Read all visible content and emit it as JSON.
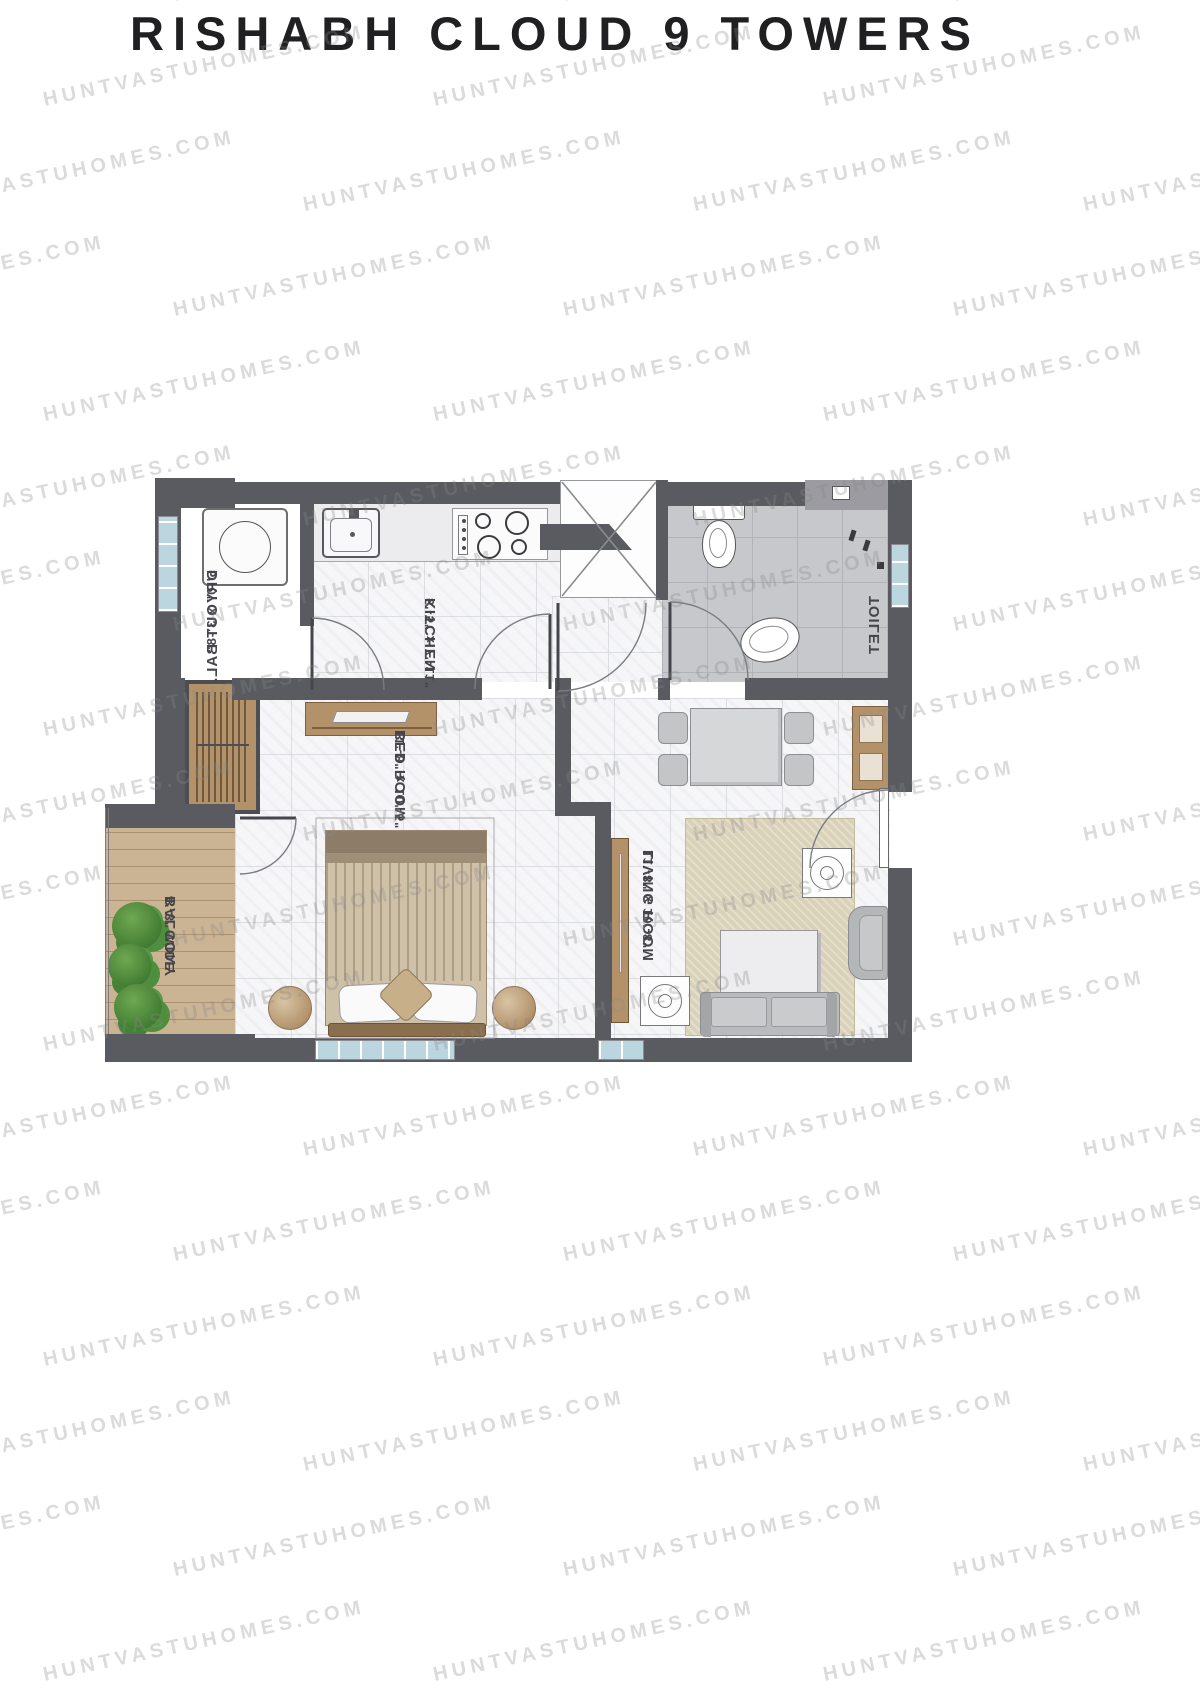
{
  "title": "RISHABH CLOUD 9 TOWERS",
  "watermark": {
    "text": "HUNTVASTUHOMES.COM"
  },
  "plan": {
    "rooms": {
      "dryout": {
        "name": "DRYOUT BAL.",
        "dims": "5'-0\" x 3'-8\""
      },
      "kitchen": {
        "name": "KITCHEN",
        "dims": "5'-5\" x 7'-11\""
      },
      "toilet": {
        "name": "TOILET",
        "dims": ""
      },
      "bedroom": {
        "name": "BED ROOM",
        "dims": "11'-8\" x 10'-5\""
      },
      "living": {
        "name": "LIVING ROOM",
        "dims": "11'-8\" x 10'-8\""
      },
      "balcony": {
        "name": "BALCONY",
        "dims": "4'-3\" WIDE"
      }
    },
    "fixtures": [
      "washbasin",
      "kitchen-sink",
      "gas-stove",
      "duct-shaft",
      "wc-toilet",
      "bathroom-basin",
      "wardrobe",
      "dresser",
      "double-bed",
      "pouf",
      "dining-table",
      "dining-chair",
      "sideboard",
      "rug",
      "coffee-table",
      "sofa",
      "armchair",
      "side-stool",
      "plant"
    ],
    "colors": {
      "wall": "#5a5b60",
      "wall_light": "#9b9ba1",
      "floor_marble": "#f6f6f8",
      "floor_toilet": "#c7c8cb",
      "wood_floor": "#c9b291",
      "wood_furniture": "#b3926a",
      "rug": "#d9d2b9",
      "sofa": "#bbbdbf",
      "window": "#bcd6e0",
      "plant": "#4e8f3e",
      "label_text": "#45454a",
      "title_text": "#202022",
      "watermark_text": "#c6c6c6"
    }
  }
}
